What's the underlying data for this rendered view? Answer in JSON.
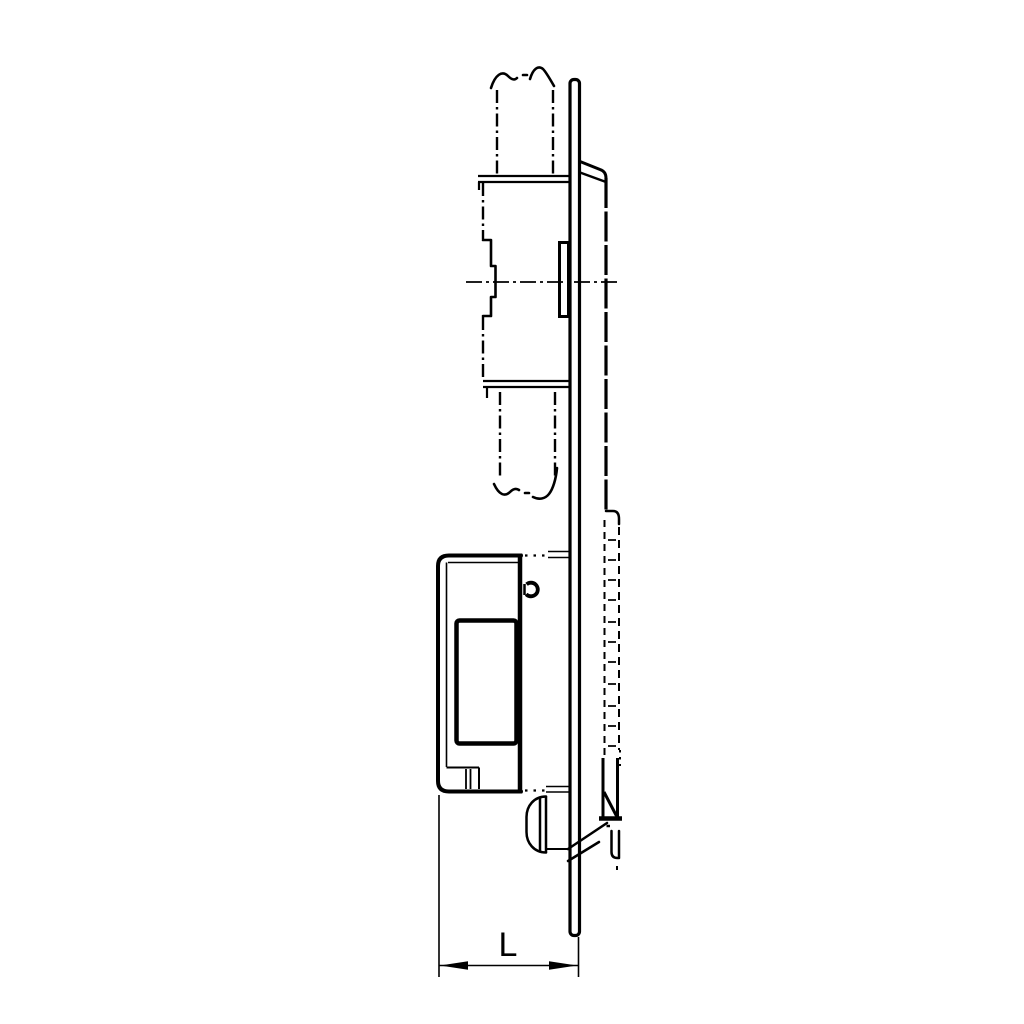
{
  "dimension": {
    "label": "L"
  },
  "colors": {
    "line": "#000000",
    "background": "#ffffff"
  },
  "parts": [
    "door-frame-phantom-outline",
    "break-line-top",
    "break-line-bottom",
    "center-line",
    "latch-bolt",
    "faceplate",
    "strike-body",
    "keeper-hidden-detail",
    "housing",
    "cover-plate",
    "screw-head",
    "mounting-knob",
    "dimension-l"
  ]
}
